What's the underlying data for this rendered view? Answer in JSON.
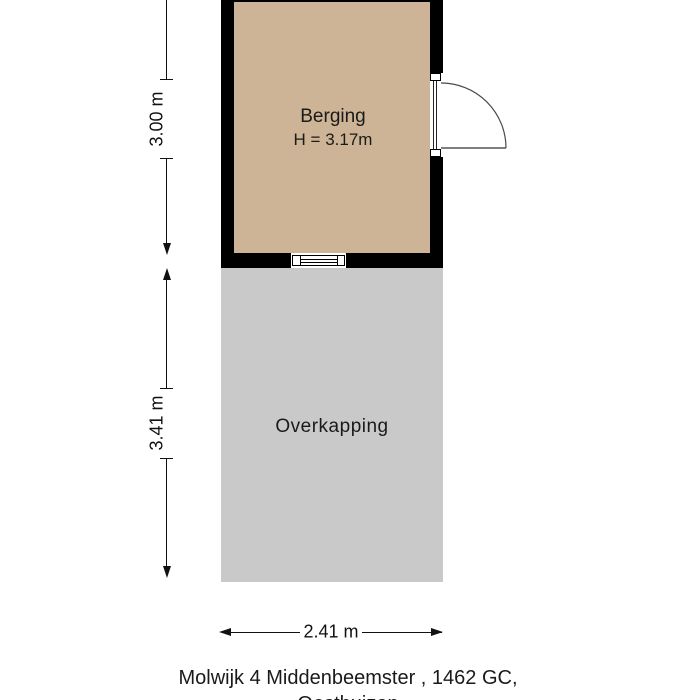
{
  "colors": {
    "wall": "#000000",
    "berging_floor": "#cdb496",
    "overkapping_floor": "#c9c9c9",
    "text": "#1a1a1a",
    "door_swing_line": "#4a4a4a"
  },
  "floorplan": {
    "berging": {
      "label": "Berging",
      "height_label": "H = 3.17m"
    },
    "overkapping": {
      "label": "Overkapping"
    },
    "dimensions": {
      "berging_depth": "3.00 m",
      "overkapping_depth": "3.41 m",
      "width": "2.41 m"
    },
    "caption": {
      "line1": "Molwijk 4 Middenbeemster , 1462 GC,",
      "line2": "Oosthuizen"
    }
  }
}
